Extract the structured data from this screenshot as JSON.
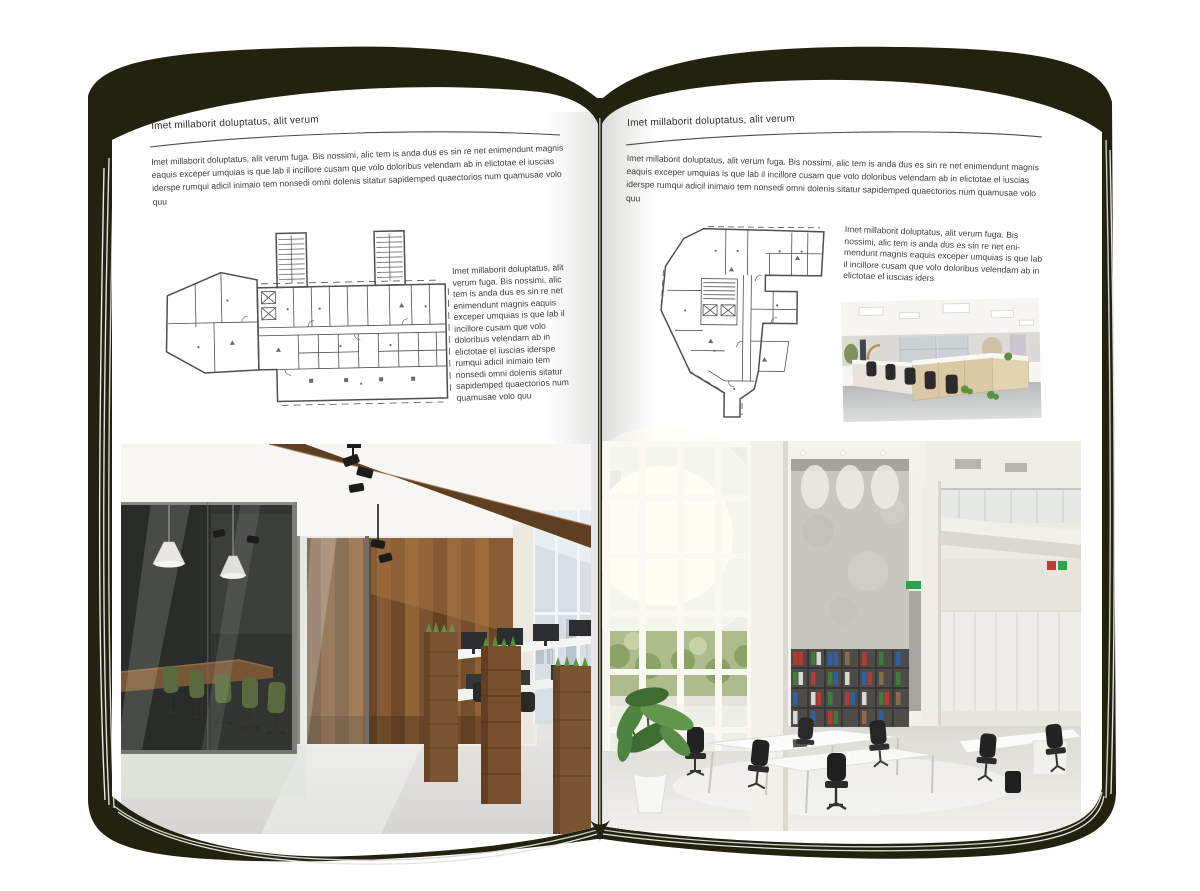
{
  "book": {
    "cover_color": "#23220f",
    "page_color": "#ffffff",
    "type": "open-magazine-spread"
  },
  "left_page": {
    "header": "Imet millaborit doluptatus, alit verum",
    "intro": "Imet millaborit doluptatus, alit verum fuga. Bis nossimi, alic tem is anda dus es sin re net enimendunt magnis eaquis exceper umquias is que lab il incillore cusam que volo doloribus velendam ab in elictotae el iuscias iderspe rumqui adicil inimaio tem nonsedi omni dolenis sitatur sapidemped quaectorios num quamusae volo quu",
    "side_text": "Imet millaborit doluptatus, alit verum fuga. Bis nossimi, alic tem is anda dus es sin re net enimendunt magnis eaquis exceper umquias is que lab il incillore cusam que volo doloribus velendam ab in elictotae el iuscias iderspe rumqui adicil inimaio tem nonsedi omni dolenis sitatur sapidemped quaectorios num quamusae volo quu",
    "floorplan_name": "wide-building-floor-plan",
    "photo_name": "office-interior-glass-meeting-room-wood-wall"
  },
  "right_page": {
    "header": "Imet millaborit doluptatus, alit verum",
    "intro": "Imet millaborit doluptatus, alit verum fuga. Bis nossimi, alic tem is anda dus es sin re net enimendunt magnis eaquis exceper umquias is que lab il incillore cusam que volo doloribus velendam ab in elictotae el iuscias iderspe rumqui adicil inimaio tem nonsedi omni dolenis sitatur sapidemped quaectorios num quamusae volo quu",
    "side_text": "Imet millaborit doluptatus, alit verum fuga. Bis nossimi, alic tem is anda dus es sin re net eni-mendunt magnis eaquis exceper umquias is que lab il incillore cusam que volo doloribus velendam ab in elictotae el iuscias iders",
    "floorplan_name": "tall-irregular-building-floor-plan",
    "photo_small_name": "open-office-workstations",
    "photo_name": "bright-double-height-loft-office"
  }
}
